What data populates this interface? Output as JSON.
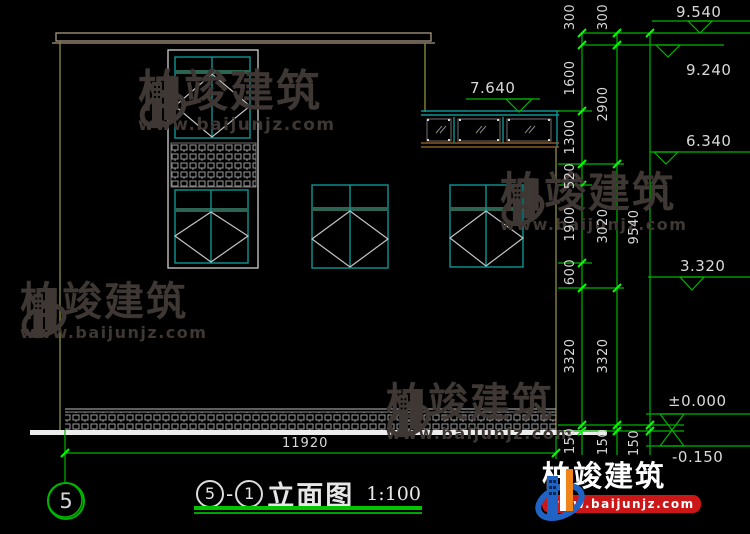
{
  "watermark": {
    "brand": "柏竣建筑",
    "url": "www.baijunjz.com"
  },
  "brand_logo": {
    "brand": "柏竣建筑",
    "url": "www.baijunjz.com"
  },
  "title_block": {
    "bubble_left": "5",
    "separator": "-",
    "bubble_right": "1",
    "name": "立面图",
    "scale": "1:100"
  },
  "grid": {
    "axis_bubble": "5"
  },
  "dimensions": {
    "overall_width": "11920",
    "col_inner": [
      "300",
      "1600",
      "1300",
      "520",
      "1900",
      "600",
      "3320",
      "150"
    ],
    "col_middle": [
      "300",
      "2900",
      "3020",
      "3320",
      "150"
    ],
    "col_outer": [
      "9540",
      "150"
    ],
    "elevations": {
      "roof_top": "9.540",
      "parapet": "9.240",
      "canopy_top": "7.640",
      "canopy_wall": "6.340",
      "mid_level": "3.320",
      "floor": "±0.000",
      "ground": "-0.150"
    }
  },
  "colors": {
    "dimension_green": "#00b400",
    "tick_green": "#00ff00",
    "window_cyan": "#0d9494",
    "wall_olive": "#7c7c34",
    "watermark_grey": "#3e3733",
    "logo_blue": "#1f63c5",
    "logo_orange": "#f08418",
    "logo_red": "#cb1717"
  }
}
